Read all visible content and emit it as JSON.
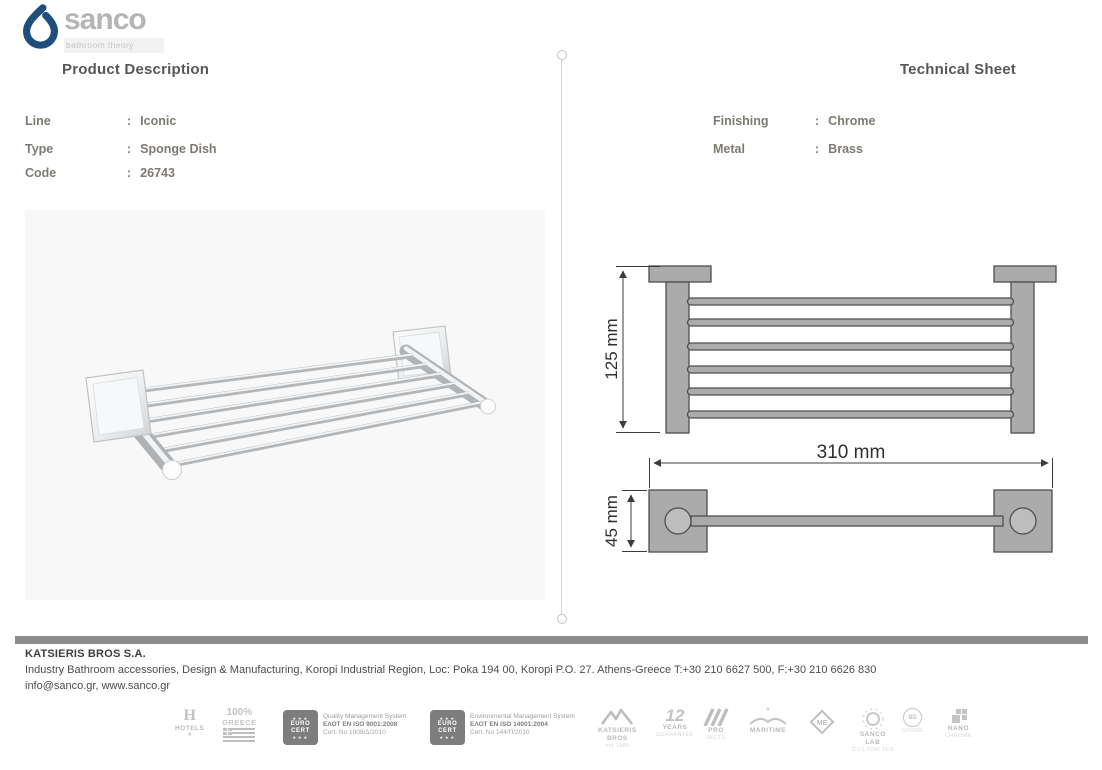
{
  "brand": {
    "name": "sanco",
    "tagline": "bathroom theory"
  },
  "left": {
    "title": "Product Description",
    "colon": ":",
    "rows": [
      {
        "label": "Line",
        "value": "Iconic"
      },
      {
        "label": "Type",
        "value": "Sponge Dish"
      },
      {
        "label": "Code",
        "value": "26743"
      }
    ]
  },
  "right": {
    "title": "Technical Sheet",
    "colon": ":",
    "rows": [
      {
        "label": "Finishing",
        "value": "Chrome"
      },
      {
        "label": "Metal",
        "value": "Brass"
      }
    ],
    "dims": {
      "height": "125 mm",
      "width": "310 mm",
      "depth": "45 mm"
    }
  },
  "footer": {
    "company": "KATSIERIS BROS S.A.",
    "address": "Industry Bathroom accessories, Design & Manufacturing, Koropi Industrial Region, Loc: Poka 194 00, Koropi P.O. 27. Athens-Greece   T:+30 210 6627 500, F:+30 210 6626 830",
    "contacts": "info@sanco.gr, www.sanco.gr"
  },
  "badges": {
    "hotels": {
      "glyph": "H",
      "label": "HOTELS",
      "star": "★"
    },
    "greece": {
      "percent": "100%",
      "label": "GREECE"
    },
    "eurocert": {
      "stars": "★★★",
      "line1": "EURO",
      "line2": "CERT"
    },
    "cert_quality": {
      "line1": "Quality Management System",
      "line2": "ΕΛΟΤ EN ISO 9001:2008",
      "line3": "Cert. No 1008/Δ/2010"
    },
    "cert_env": {
      "line1": "Environmental Management System",
      "line2": "ΕΛΟΤ EN ISO 14001:2004",
      "line3": "Cert. No 144/Π/2010"
    },
    "katsieris": {
      "line1": "KATSIERIS",
      "line2": "BROS",
      "line3": "est 1980"
    },
    "years": {
      "number": "12",
      "line1": "YEARS",
      "line2": "GUARANTEE"
    },
    "pro": {
      "line1": "PRO",
      "line2": "JECTS"
    },
    "maritime": {
      "star": "★",
      "label": "MARITIME"
    },
    "me": {
      "label": "ME"
    },
    "sancolab": {
      "line1": "SANCO",
      "line2": "LAB",
      "line3": "CUS TOM TES"
    },
    "spore": {
      "inner": "BS",
      "label": "SPORE"
    },
    "nano": {
      "line1": "NANO",
      "line2": "CHROME"
    }
  },
  "colors": {
    "brand_blue": "#1d4e7d",
    "heading_gray": "#57575a",
    "info_text": "#7d7a71",
    "drawing_gray": "#ababab",
    "footer_bar": "#8c8c8c",
    "badge_gray": "#b9b9b9"
  }
}
